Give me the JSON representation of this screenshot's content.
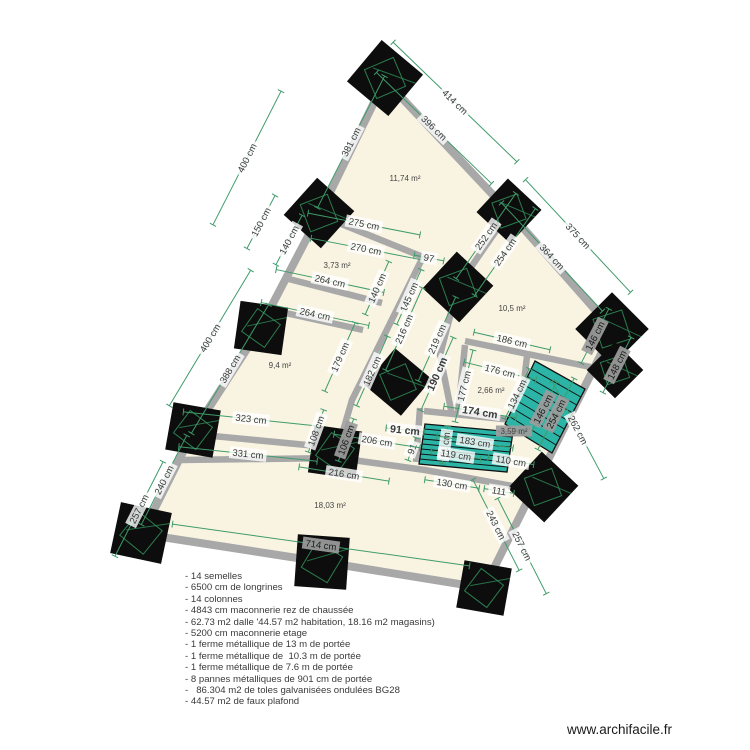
{
  "app": {
    "watermark": "www.archifacile.fr"
  },
  "colors": {
    "floor": "#f9f4e2",
    "wall": "#a8a8a8",
    "column": "#0d0d0d",
    "column_detail": "#2e8b57",
    "stair_fill": "#2cb5a6",
    "stair_line": "#111111",
    "dim_line": "#3f9b6b",
    "dim_text": "#3a3a3a",
    "dim_text_dark_bg": "#9c9c9c",
    "room_text": "#444444"
  },
  "plan": {
    "outer_wall": [
      [
        385,
        80
      ],
      [
        509,
        212
      ],
      [
        613,
        330
      ],
      [
        484,
        588
      ],
      [
        323,
        562
      ],
      [
        142,
        534
      ],
      [
        192,
        434
      ],
      [
        258,
        332
      ],
      [
        319,
        215
      ]
    ],
    "inner_walls": [
      [
        [
          319,
          215
        ],
        [
          423,
          257
        ]
      ],
      [
        [
          509,
          212
        ],
        [
          458,
          286
        ],
        [
          440,
          355
        ],
        [
          452,
          415
        ]
      ],
      [
        [
          423,
          257
        ],
        [
          352,
          400
        ],
        [
          338,
          448
        ]
      ],
      [
        [
          285,
          278
        ],
        [
          382,
          303
        ]
      ],
      [
        [
          272,
          310
        ],
        [
          363,
          330
        ]
      ],
      [
        [
          192,
          434
        ],
        [
          338,
          448
        ]
      ],
      [
        [
          181,
          460
        ],
        [
          338,
          458
        ],
        [
          425,
          470
        ],
        [
          545,
          492
        ]
      ],
      [
        [
          465,
          341
        ],
        [
          605,
          370
        ]
      ],
      [
        [
          465,
          345
        ],
        [
          458,
          413
        ]
      ],
      [
        [
          527,
          356
        ],
        [
          520,
          417
        ]
      ],
      [
        [
          424,
          411
        ],
        [
          523,
          421
        ]
      ],
      [
        [
          420,
          408
        ],
        [
          416,
          462
        ]
      ]
    ],
    "columns": [
      [
        385,
        78,
        54,
        40
      ],
      [
        509,
        211,
        46,
        43
      ],
      [
        612,
        329,
        52,
        45
      ],
      [
        615,
        370,
        40,
        45
      ],
      [
        319,
        213,
        50,
        42
      ],
      [
        261,
        328,
        48,
        8
      ],
      [
        193,
        430,
        48,
        10
      ],
      [
        141,
        533,
        52,
        12
      ],
      [
        322,
        562,
        52,
        4
      ],
      [
        484,
        588,
        48,
        10
      ],
      [
        543,
        487,
        50,
        43
      ],
      [
        458,
        287,
        50,
        43
      ],
      [
        398,
        382,
        48,
        40
      ],
      [
        335,
        452,
        48,
        8
      ]
    ],
    "stairs": [
      {
        "corners": [
          [
            425,
            424
          ],
          [
            513,
            432
          ],
          [
            507,
            472
          ],
          [
            419,
            464
          ]
        ],
        "treads": 8
      },
      {
        "corners": [
          [
            535,
            361
          ],
          [
            585,
            389
          ],
          [
            552,
            453
          ],
          [
            505,
            424
          ]
        ],
        "treads": 8
      }
    ],
    "dimensions": [
      {
        "t": "400 cm",
        "x": 247,
        "y": 158,
        "r": -63,
        "l": 150
      },
      {
        "t": "381 cm",
        "x": 351,
        "y": 142,
        "r": -63,
        "l": 148
      },
      {
        "t": "150 cm",
        "x": 261,
        "y": 222,
        "r": -62,
        "l": 60
      },
      {
        "t": "140 cm",
        "x": 289,
        "y": 240,
        "r": -62,
        "l": 56
      },
      {
        "t": "400 cm",
        "x": 210,
        "y": 338,
        "r": -59,
        "l": 158
      },
      {
        "t": "388 cm",
        "x": 230,
        "y": 369,
        "r": -59,
        "l": 150
      },
      {
        "t": "257 cm",
        "x": 139,
        "y": 509,
        "r": -63,
        "l": 106
      },
      {
        "t": "240 cm",
        "x": 164,
        "y": 480,
        "r": -63,
        "l": 100
      },
      {
        "t": "414 cm",
        "x": 455,
        "y": 102,
        "r": 44,
        "l": 172
      },
      {
        "t": "396 cm",
        "x": 434,
        "y": 128,
        "r": 44,
        "l": 160
      },
      {
        "t": "375 cm",
        "x": 578,
        "y": 236,
        "r": 47,
        "l": 154
      },
      {
        "t": "364 cm",
        "x": 552,
        "y": 257,
        "r": 47,
        "l": 148
      },
      {
        "t": "262 cm",
        "x": 578,
        "y": 430,
        "r": 62,
        "l": 110
      },
      {
        "t": "243 cm",
        "x": 496,
        "y": 525,
        "r": 63,
        "l": 102
      },
      {
        "t": "257 cm",
        "x": 522,
        "y": 546,
        "r": 63,
        "l": 107
      },
      {
        "t": "714 cm",
        "x": 321,
        "y": 545,
        "r": 8,
        "l": 300,
        "d": 1
      },
      {
        "t": "275 cm",
        "x": 364,
        "y": 224,
        "r": 11,
        "l": 114
      },
      {
        "t": "270 cm",
        "x": 366,
        "y": 249,
        "r": 11,
        "l": 112
      },
      {
        "t": "97",
        "x": 429,
        "y": 258,
        "r": 11,
        "l": 30
      },
      {
        "t": "252 cm",
        "x": 486,
        "y": 236,
        "r": -55,
        "l": 104
      },
      {
        "t": "254 cm",
        "x": 505,
        "y": 252,
        "r": -55,
        "l": 106
      },
      {
        "t": "264 cm",
        "x": 330,
        "y": 281,
        "r": 12,
        "l": 110
      },
      {
        "t": "264 cm",
        "x": 315,
        "y": 314,
        "r": 12,
        "l": 110
      },
      {
        "t": "140 cm",
        "x": 377,
        "y": 288,
        "r": -66,
        "l": 58
      },
      {
        "t": "145 cm",
        "x": 409,
        "y": 297,
        "r": -66,
        "l": 60
      },
      {
        "t": "216 cm",
        "x": 404,
        "y": 329,
        "r": -66,
        "l": 90
      },
      {
        "t": "219 cm",
        "x": 437,
        "y": 339,
        "r": -66,
        "l": 92
      },
      {
        "t": "190 cm",
        "x": 437,
        "y": 374,
        "r": -66,
        "l": 80,
        "b": 1
      },
      {
        "t": "179 cm",
        "x": 340,
        "y": 357,
        "r": -66,
        "l": 75
      },
      {
        "t": "182 cm",
        "x": 372,
        "y": 371,
        "r": -66,
        "l": 76
      },
      {
        "t": "186 cm",
        "x": 512,
        "y": 341,
        "r": 13,
        "l": 78
      },
      {
        "t": "176 cm",
        "x": 500,
        "y": 371,
        "r": 14,
        "l": 74
      },
      {
        "t": "177 cm",
        "x": 464,
        "y": 386,
        "r": -76,
        "l": 74
      },
      {
        "t": "134 cm",
        "x": 517,
        "y": 394,
        "r": -64,
        "l": 56
      },
      {
        "t": "174 cm",
        "x": 480,
        "y": 412,
        "r": 9,
        "l": 73,
        "b": 1
      },
      {
        "t": "91 cm",
        "x": 405,
        "y": 430,
        "r": 6,
        "l": 38,
        "b": 1
      },
      {
        "t": "91",
        "x": 412,
        "y": 449,
        "r": -70,
        "l": 24
      },
      {
        "t": "91 cm",
        "x": 445,
        "y": 445,
        "r": -82,
        "l": 38
      },
      {
        "t": "183 cm",
        "x": 475,
        "y": 442,
        "r": 9,
        "l": 77
      },
      {
        "t": "119 cm",
        "x": 456,
        "y": 455,
        "r": 9,
        "l": 50
      },
      {
        "t": "110 cm",
        "x": 511,
        "y": 461,
        "r": 9,
        "l": 46
      },
      {
        "t": "130 cm",
        "x": 452,
        "y": 484,
        "r": 9,
        "l": 55
      },
      {
        "t": "111",
        "x": 499,
        "y": 491,
        "r": 9,
        "l": 30
      },
      {
        "t": "206 cm",
        "x": 377,
        "y": 441,
        "r": 9,
        "l": 87
      },
      {
        "t": "216 cm",
        "x": 344,
        "y": 474,
        "r": 9,
        "l": 91
      },
      {
        "t": "323 cm",
        "x": 251,
        "y": 419,
        "r": 6,
        "l": 136
      },
      {
        "t": "331 cm",
        "x": 248,
        "y": 454,
        "r": 6,
        "l": 139
      },
      {
        "t": "108 cm",
        "x": 316,
        "y": 431,
        "r": -70,
        "l": 45
      },
      {
        "t": "106 cm",
        "x": 346,
        "y": 440,
        "r": -70,
        "l": 45,
        "d": 1
      },
      {
        "t": "146 cm",
        "x": 543,
        "y": 409,
        "r": -63,
        "l": 61,
        "d": 1
      },
      {
        "t": "254 cm",
        "x": 556,
        "y": 414,
        "r": -63,
        "l": 80,
        "d": 1
      },
      {
        "t": "146 cm",
        "x": 595,
        "y": 336,
        "r": -63,
        "l": 61,
        "d": 1
      },
      {
        "t": "148 cm",
        "x": 617,
        "y": 365,
        "r": -63,
        "l": 62,
        "d": 1
      }
    ],
    "rooms": [
      {
        "t": "11,74 m²",
        "x": 405,
        "y": 178
      },
      {
        "t": "3,73 m²",
        "x": 337,
        "y": 265
      },
      {
        "t": "10,5 m²",
        "x": 512,
        "y": 308
      },
      {
        "t": "9,4 m²",
        "x": 280,
        "y": 365
      },
      {
        "t": "2,66 m²",
        "x": 491,
        "y": 390
      },
      {
        "t": "3,59 m²",
        "x": 514,
        "y": 431,
        "d": 1
      },
      {
        "t": "18,03 m²",
        "x": 330,
        "y": 505
      }
    ]
  },
  "notes": {
    "items": [
      "- 14 semelles",
      "- 6500 cm de longrines",
      "- 14 colonnes",
      "- 4843 cm maconnerie rez de chaussée",
      "- 62.73 m2 dalle '44.57 m2 habitation, 18.16 m2 magasins)",
      "- 5200 cm maconnerie etage",
      "- 1 ferme métallique de 13 m de portée",
      "- 1 ferme métallique de  10.3 m de portée",
      "- 1 ferme métallique de 7.6 m de portée",
      "- 8 pannes métalliques de 901 cm de portée",
      "-   86.304 m2 de toles galvanisées ondulées BG28",
      "- 44.57 m2 de faux plafond"
    ],
    "left": 185,
    "top": 571
  }
}
